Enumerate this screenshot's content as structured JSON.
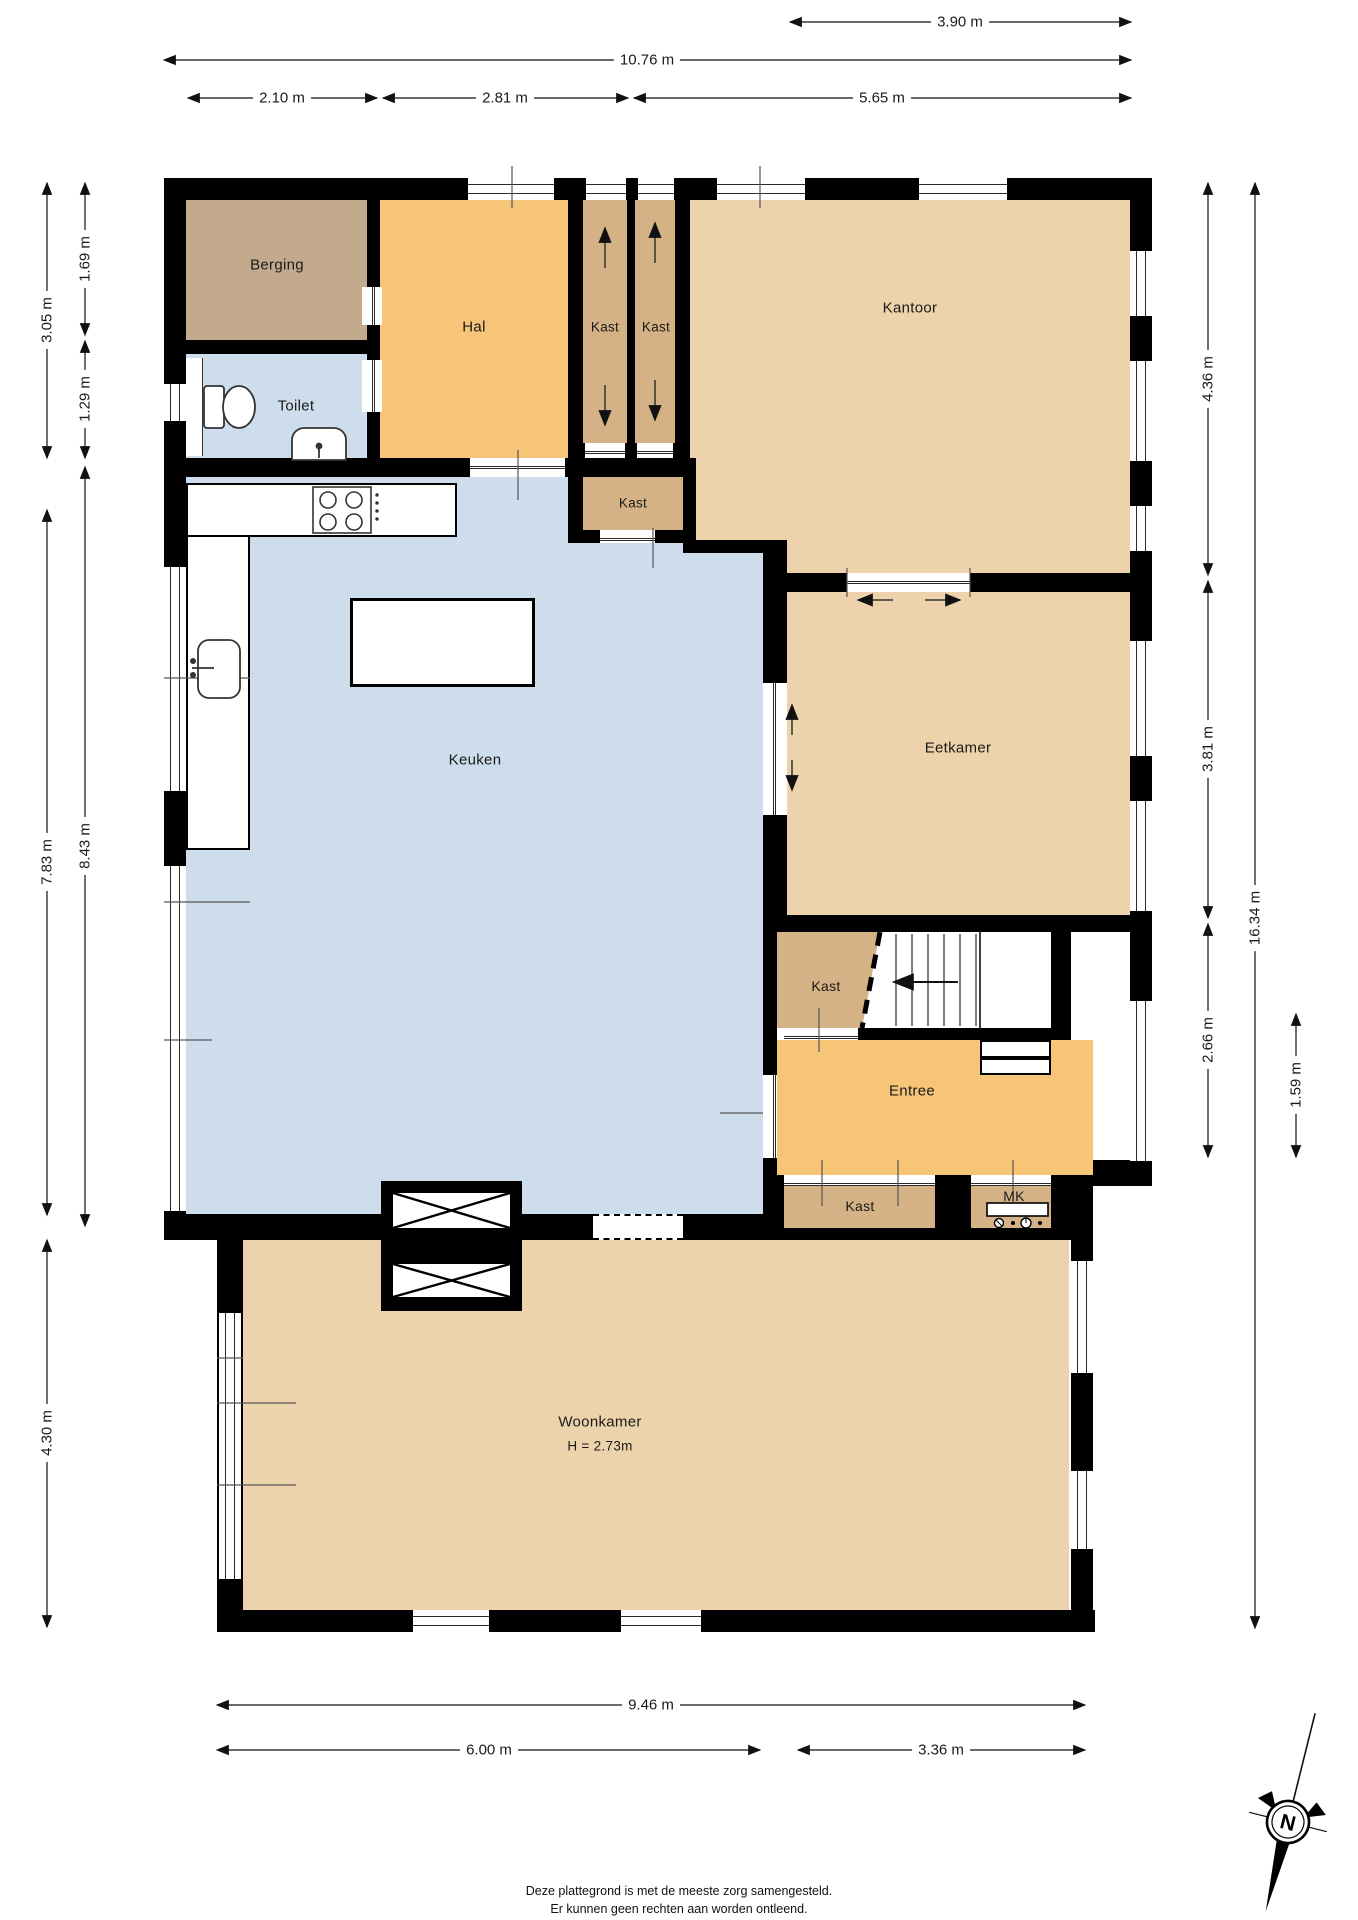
{
  "title": "Plattegrond begane grond",
  "rooms": {
    "berging": {
      "label": "Berging"
    },
    "toilet": {
      "label": "Toilet"
    },
    "hal": {
      "label": "Hal"
    },
    "kast_hal_left": {
      "label": "Kast"
    },
    "kast_hal_right": {
      "label": "Kast"
    },
    "kantoor": {
      "label": "Kantoor"
    },
    "kast_keuken": {
      "label": "Kast"
    },
    "keuken": {
      "label": "Keuken"
    },
    "eetkamer": {
      "label": "Eetkamer"
    },
    "kast_trap": {
      "label": "Kast"
    },
    "entree": {
      "label": "Entree"
    },
    "kast_entree": {
      "label": "Kast"
    },
    "mk": {
      "label": "MK"
    },
    "woonkamer": {
      "label": "Woonkamer",
      "height_note": "H = 2.73m"
    }
  },
  "dimensions": {
    "top": [
      "3.90 m",
      "10.76 m",
      "2.10 m",
      "2.81 m",
      "5.65 m"
    ],
    "left": [
      "3.05 m",
      "1.69 m",
      "1.29 m",
      "7.83 m",
      "8.43 m",
      "4.30 m"
    ],
    "right": [
      "4.36 m",
      "3.81 m",
      "2.66 m",
      "16.34 m",
      "1.59 m"
    ],
    "bottom": [
      "9.46 m",
      "6.00 m",
      "3.36 m"
    ]
  },
  "compass": {
    "label": "N"
  },
  "footer": {
    "line1": "Deze plattegrond is met de meeste zorg samengesteld.",
    "line2": "Er kunnen geen rechten aan worden ontleend."
  },
  "colors": {
    "wall": "#000000",
    "floor_orange": "#F6C578",
    "floor_tan": "#C4AA8D",
    "floor_closet": "#D4B285",
    "floor_beige": "#EDD3AB",
    "floor_blue": "#CEDDEB"
  }
}
